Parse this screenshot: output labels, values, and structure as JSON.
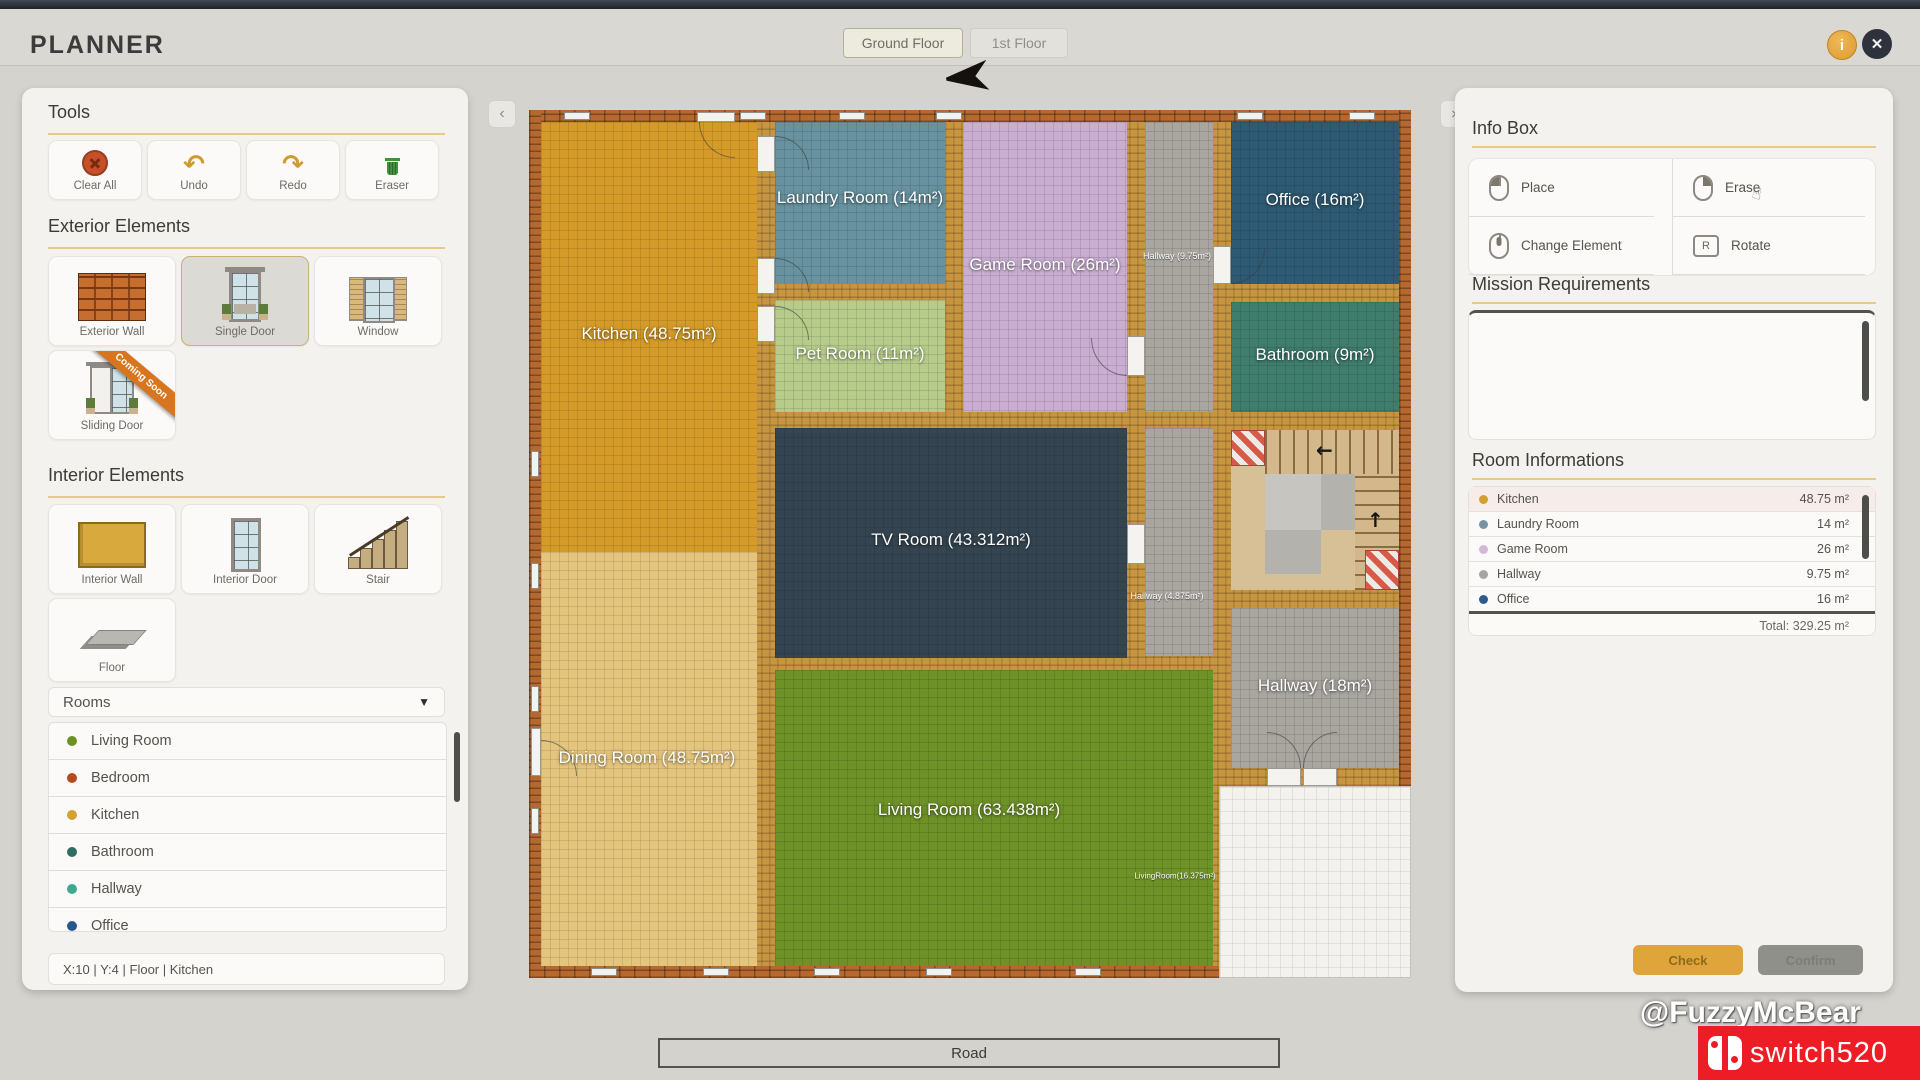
{
  "app": {
    "title": "PLANNER"
  },
  "header": {
    "tabs": [
      {
        "label": "Ground Floor"
      },
      {
        "label": "1st Floor"
      }
    ],
    "info_glyph": "i",
    "close_glyph": "✕"
  },
  "panel_toggle": {
    "left": "‹",
    "right": "›"
  },
  "left_panel": {
    "tools": {
      "title": "Tools",
      "buttons": [
        {
          "label": "Clear All"
        },
        {
          "label": "Undo",
          "glyph": "↶"
        },
        {
          "label": "Redo",
          "glyph": "↷"
        },
        {
          "label": "Eraser"
        }
      ]
    },
    "exterior": {
      "title": "Exterior Elements",
      "items": [
        {
          "label": "Exterior Wall"
        },
        {
          "label": "Single Door"
        },
        {
          "label": "Window"
        },
        {
          "label": "Sliding Door",
          "badge": "Coming Soon"
        }
      ]
    },
    "interior": {
      "title": "Interior Elements",
      "items": [
        {
          "label": "Interior Wall"
        },
        {
          "label": "Interior Door"
        },
        {
          "label": "Stair"
        },
        {
          "label": "Floor"
        }
      ]
    },
    "rooms_dropdown": {
      "label": "Rooms",
      "arrow": "▼",
      "options": [
        {
          "label": "Living Room",
          "color": "#6f9023"
        },
        {
          "label": "Bedroom",
          "color": "#b54a1e"
        },
        {
          "label": "Kitchen",
          "color": "#d2a12e"
        },
        {
          "label": "Bathroom",
          "color": "#2e6e5e"
        },
        {
          "label": "Hallway",
          "color": "#3fa98e"
        },
        {
          "label": "Office",
          "color": "#27588c"
        }
      ]
    },
    "status_bar": "X:10   |   Y:4   |   Floor   |   Kitchen"
  },
  "canvas": {
    "rooms": [
      {
        "name": "Kitchen",
        "label": "Kitchen (48.75m²)",
        "color": "#d49b28"
      },
      {
        "name": "Dining Room",
        "label": "Dining Room (48.75m²)",
        "color": "#e4c57e"
      },
      {
        "name": "Laundry Room",
        "label": "Laundry Room (14m²)",
        "color": "#68929f"
      },
      {
        "name": "Pet Room",
        "label": "Pet Room (11m²)",
        "color": "#b7cb8b"
      },
      {
        "name": "Game Room",
        "label": "Game Room (26m²)",
        "color": "#c9aed2"
      },
      {
        "name": "TV Room",
        "label": "TV Room (43.312m²)",
        "color": "#344551"
      },
      {
        "name": "Living Room",
        "label": "Living Room (63.438m²)",
        "color": "#6e9128"
      },
      {
        "name": "Office",
        "label": "Office (16m²)",
        "color": "#2e5a74"
      },
      {
        "name": "Bathroom",
        "label": "Bathroom (9m²)",
        "color": "#3f7d6d"
      },
      {
        "name": "Hallway",
        "label": "Hallway (18m²)",
        "color": "#a9a6a0"
      },
      {
        "name": "Hallway small",
        "label": "Hallway (9.75m²)",
        "color": "#a9a6a0"
      },
      {
        "name": "Hallway mid",
        "label": "Hallway (4.875m²)",
        "color": "#a9a6a0"
      },
      {
        "name": "Living Room strip",
        "label": "LivingRoom(16.375m²)",
        "color": "#6e9128"
      }
    ],
    "stairs": {
      "arrow_left": "←",
      "arrow_up": "↑"
    },
    "road_label": "Road"
  },
  "right_panel": {
    "info_box": {
      "title": "Info Box",
      "cursor_glyph": "☝",
      "actions": [
        {
          "label": "Place",
          "icon": "mouse-left"
        },
        {
          "label": "Erase",
          "icon": "mouse-right"
        },
        {
          "label": "Change Element",
          "icon": "mouse-wheel"
        },
        {
          "label": "Rotate",
          "icon": "key-r",
          "key": "R"
        }
      ]
    },
    "mission": {
      "title": "Mission Requirements"
    },
    "room_info": {
      "title": "Room Informations",
      "rows": [
        {
          "name": "Kitchen",
          "area": "48.75 m²",
          "color": "#d2a12e"
        },
        {
          "name": "Laundry Room",
          "area": "14 m²",
          "color": "#7793a3"
        },
        {
          "name": "Game Room",
          "area": "26 m²",
          "color": "#d3b9d6"
        },
        {
          "name": "Hallway",
          "area": "9.75 m²",
          "color": "#a8a5a0"
        },
        {
          "name": "Office",
          "area": "16 m²",
          "color": "#2e5a8c"
        }
      ],
      "total": "Total: 329.25 m²"
    },
    "buttons": {
      "check": "Check",
      "confirm": "Confirm"
    }
  },
  "watermark": {
    "handle": "@FuzzyMcBear",
    "logo_text": "switch520"
  }
}
